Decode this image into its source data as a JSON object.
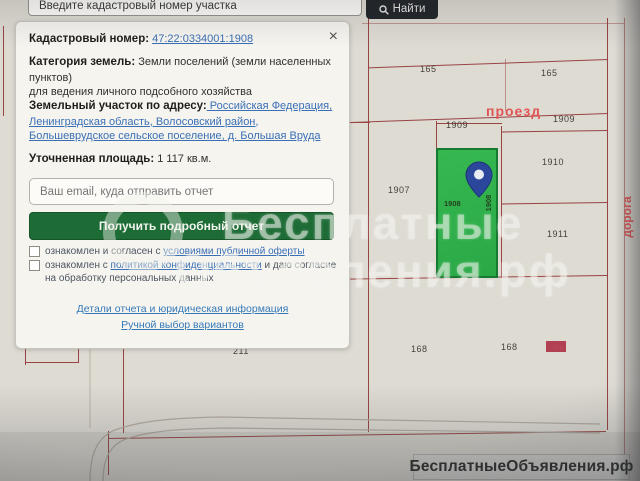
{
  "top_bar": {
    "search_value": "Введите кадастровый номер участка",
    "find_button": "Найти"
  },
  "panel": {
    "cadastral_label": "Кадастровый номер:",
    "cadastral_number": "47:22:0334001:1908",
    "close_x": "×",
    "category_label": "Категория земель:",
    "category_value": " Земли поселений (земли населенных пунктов)",
    "category_extra": "для ведения личного подсобного хозяйства",
    "address_label": "Земельный участок по адресу:",
    "address_value": " Российская Федерация, Ленинградская область, Волосовский район, Большеврудское сельское поселение, д. Большая Вруда",
    "area_label": "Уточненная площадь:",
    "area_value": " 1 117 кв.м.",
    "email_placeholder": "Ваш email, куда отправить отчет",
    "report_button": "Получить подробный отчет",
    "checkbox1_prefix": "ознакомлен и согласен с ",
    "checkbox1_link": "условиями публичной оферты",
    "checkbox2_prefix": "ознакомлен с ",
    "checkbox2_link": "политикой конфиденциальности",
    "checkbox2_suffix": " и даю согласие на обработку персональных данных",
    "details_link": "Детали отчета и юридическая информация",
    "manual_link": "Ручной выбор вариантов"
  },
  "map": {
    "parcel_labels": [
      {
        "text": "165",
        "x": 420,
        "y": 64
      },
      {
        "text": "165",
        "x": 541,
        "y": 68
      },
      {
        "text": "1909",
        "x": 446,
        "y": 120
      },
      {
        "text": "1909",
        "x": 553,
        "y": 114
      },
      {
        "text": "1910",
        "x": 542,
        "y": 157
      },
      {
        "text": "1907",
        "x": 388,
        "y": 185
      },
      {
        "text": "1911",
        "x": 547,
        "y": 229
      },
      {
        "text": "211",
        "x": 233,
        "y": 346
      },
      {
        "text": "168",
        "x": 411,
        "y": 344
      },
      {
        "text": "168",
        "x": 501,
        "y": 342
      }
    ],
    "selected_parcel_number": "1908",
    "selected_parcel_number_vertical": "1908",
    "red_parcel_label": "879",
    "road_label_horizontal": "проезд",
    "road_label_vertical": "дорога"
  },
  "watermark": {
    "line1": "Бесплатные",
    "line2": "Объявления.рф"
  },
  "footer_logo": "БесплатныеОбъявления.рф",
  "colors": {
    "map_line": "#9a4343",
    "road_red": "#e25555",
    "parcel_green": "#2fb14c",
    "parcel_green_border": "#167a31",
    "pin_blue": "#2b479c",
    "button_green": "#1d6b35",
    "link_blue": "#3a6fb5",
    "find_button_bg": "#23262a",
    "red_parcel": "#b04052"
  }
}
